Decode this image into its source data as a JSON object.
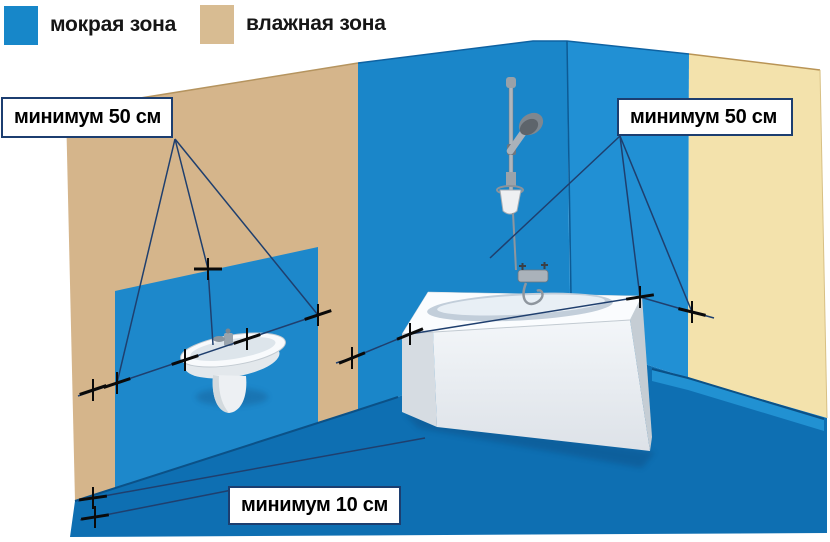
{
  "legend": {
    "items": [
      {
        "id": "wet-zone",
        "label": "мокрая зона",
        "color": "#1787c9"
      },
      {
        "id": "damp-zone",
        "label": "влажная зона",
        "color": "#d8bc92"
      }
    ]
  },
  "annotations": {
    "sink_distance": "минимум 50 см",
    "bath_distance": "минимум 50 см",
    "floor_distance": "минимум 10 см"
  },
  "scene": {
    "type": "bathroom-waterproofing-zones-diagram",
    "fixtures": [
      "pedestal-sink",
      "bathtub",
      "shower-rail-with-hand-shower",
      "bath-mixer-tap"
    ],
    "colors": {
      "wet_zone_blue": "#1787c9",
      "damp_zone_tan": "#d8bc92",
      "left_wall_tan": "#d5b58b",
      "right_wall_cream": "#f3e2ac",
      "back_wall_blue": "#1a86c9",
      "right_wall_blue": "#2190d4",
      "wet_panel_blue": "#1d88cb",
      "floor_blue": "#0e6fb2",
      "dimension_line": "#1f3f6e",
      "marker_black": "#0a0a0a",
      "label_border": "#1c3e70"
    }
  }
}
